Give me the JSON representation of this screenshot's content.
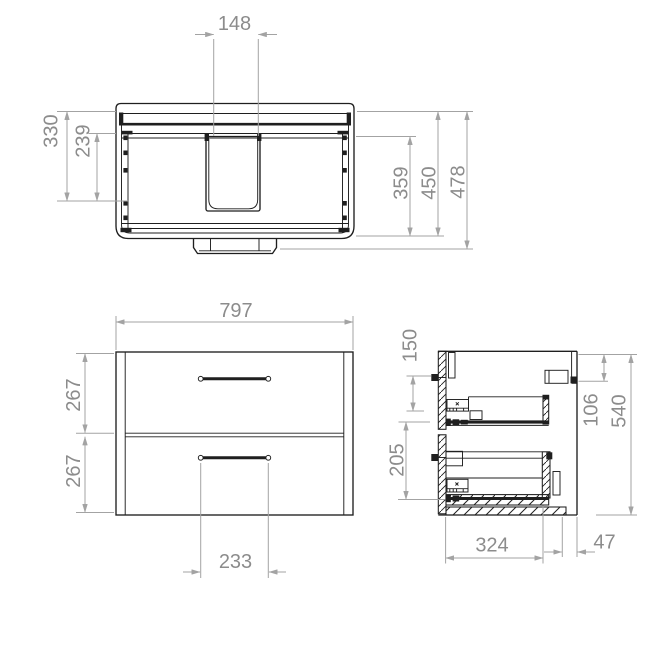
{
  "drawing": {
    "type": "technical-orthographic-drawing",
    "subject": "wall-hung vanity unit with two drawers and basin cutout",
    "colors": {
      "outline": "#1f1f1f",
      "dimension": "#a3a3a3",
      "dimension_text": "#8c8c8c",
      "background": "#ffffff"
    }
  },
  "views": {
    "top": {
      "dims": {
        "cutout_width": "148",
        "cutout_offset_outer": "330",
        "cutout_offset_inner": "239",
        "interior_depth": "359",
        "carcass_depth": "450",
        "overall_depth": "478"
      }
    },
    "front": {
      "dims": {
        "overall_width": "797",
        "upper_drawer_height": "267",
        "lower_drawer_height": "267",
        "handle_spacing": "233"
      }
    },
    "side": {
      "dims": {
        "upper_runner_offset": "150",
        "runner_spacing": "205",
        "bracket_offset": "106",
        "overall_height": "540",
        "runner_length": "324",
        "rear_clearance": "47"
      }
    }
  }
}
